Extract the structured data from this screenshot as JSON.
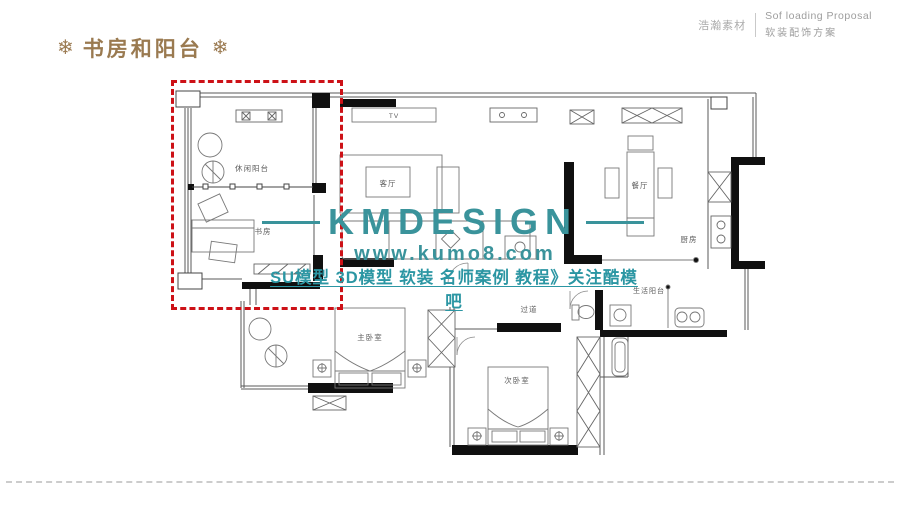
{
  "header": {
    "title": "书房和阳台",
    "ornament_glyph": "❄",
    "title_color": "#9a7a50",
    "brand": {
      "cn": "浩瀚素材",
      "en_line1": "Sof loading Proposal",
      "en_line2": "软装配饰方案"
    }
  },
  "watermark": {
    "brand": "KMDESIGN",
    "url": "www.kumo8.com",
    "tagline": "SU模型 3D模型 软装 名师案例 教程》关注酷模吧",
    "color": "#3a939b"
  },
  "floor_plan": {
    "highlight_color": "#cd1117",
    "labels": {
      "leisure_balcony": "休闲阳台",
      "study": "书房",
      "living_room": "客厅",
      "tv": "TV",
      "dining_room": "餐厅",
      "kitchen": "厨房",
      "hallway": "过道",
      "master_bedroom": "主卧室",
      "second_bedroom": "次卧室",
      "utility_balcony": "生活阳台"
    }
  }
}
